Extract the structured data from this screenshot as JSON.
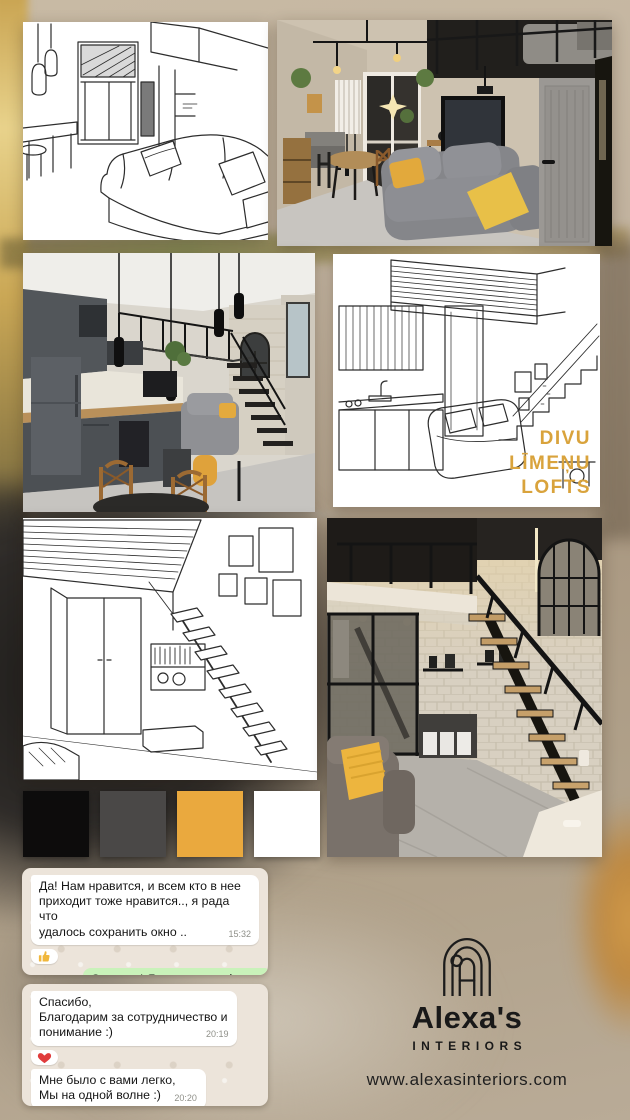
{
  "collage": {
    "caption": "DIVU\nLĪMEŅU\nLOFTS",
    "caption_color": "#d9a33c",
    "tiles": [
      "sketch-living-room",
      "photo-loft-living-room",
      "photo-kitchen-loft",
      "sketch-kitchen-loft",
      "sketch-stair-room",
      "photo-loft-staircase"
    ]
  },
  "palette": {
    "swatches": [
      "#0d0c0c",
      "#4a4847",
      "#eaa93e",
      "#ffffff"
    ]
  },
  "chat": {
    "incoming_bubble_color": "#ffffff",
    "outgoing_bubble_color": "#c9f2ba",
    "groups": [
      {
        "messages": [
          {
            "side": "incoming",
            "text": "Да! Нам нравится,  и всем кто в нее\nприходит тоже нравится.., я рада  что\nудалось сохранить окно ..",
            "time": "15:32"
          },
          {
            "side": "incoming",
            "icon": "thumbs-up"
          },
          {
            "side": "outgoing",
            "text": "Отлично! Я очень рада :)",
            "time": "15:36"
          }
        ]
      },
      {
        "messages": [
          {
            "side": "incoming",
            "text": "Спасибо,\nБлагодарим за сотрудничество и\nпонимание  :)",
            "time": "20:19"
          },
          {
            "side": "incoming",
            "icon": "heart"
          },
          {
            "side": "incoming",
            "text": "Мне было с вами легко,\nМы на одной волне :)",
            "time": "20:20"
          },
          {
            "side": "incoming",
            "icon": "heart"
          }
        ]
      }
    ]
  },
  "brand": {
    "logo_icon": "arch-monogram",
    "name": "Alexa's",
    "tagline": "INTERIORS",
    "website": "www.alexasinteriors.com"
  }
}
